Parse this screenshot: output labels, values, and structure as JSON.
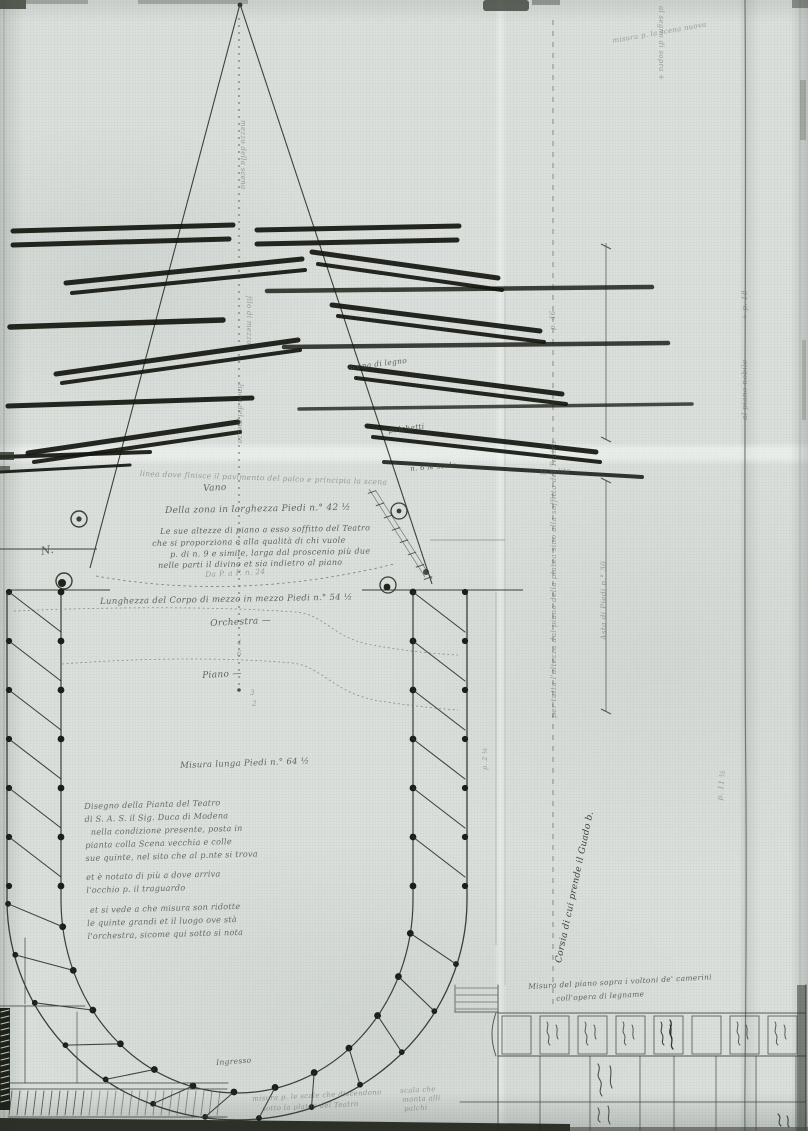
{
  "document_kind": "scanned hand-drawn theatre plan",
  "colors": {
    "paper": "#dbe0dd",
    "ink": "#2e332b",
    "ink_faint": "#6c766c",
    "wing_bars": "#14170f"
  },
  "annotations": {
    "top_right_vertical": "al segno di sopra +",
    "top_right_note": "misura p. la scena nuova",
    "center_line_1": "mezzo della scena",
    "center_line_2": "filo di mezzo",
    "center_line_3": "linea del mezzo",
    "wing_label_1": "scena di legno",
    "wing_label_2": "palchetti",
    "wing_label_3": "n. 6 le scale",
    "wing_label_4": "le solite",
    "stage_front_note": "linea dove finisce il pavimento del palco e principia la scena",
    "vano_label": "Vano",
    "width_note": "Della zona in larghezza Piedi n.° 42 ½",
    "stage_paragraph": [
      "Le sue altezze di piano a esso soffitto del Teatro",
      "che si proporziona e alla qualità di chi vuole",
      "p. di n. 9 e simile, larga dal proscenio più due",
      "nelle parti il divino et sia indietro al piano"
    ],
    "da_p_a_p": "Da P. a P. n. 24",
    "length_note": "Lunghezza del Corpo di mezzo in mezzo Piedi n.° 54 ½",
    "orchestra_label": "Orchestra —",
    "orchestra_fraction": {
      "top": "4",
      "bottom": "6"
    },
    "piano_label": "Piano —",
    "piano_fraction": {
      "top": "3",
      "bottom": "2"
    },
    "measure_note": "Misura lunga Piedi n.° 64 ½",
    "nn_label": "N.",
    "legend_lines": [
      "Disegno della Pianta del Teatro",
      "di S. A. S. il Sig. Duca di Modena",
      "nella condizione presente, posta in",
      "pianta colla Scena vecchia e colle",
      "sue quinte, nel sito che al p.nte si trova",
      "et è notato di più a dove arriva",
      "l'occhio p. il traguardo",
      "et si vede a che misura son ridotte",
      "le quinte grandi et il luogo ove stà",
      "l'orchestra, sicome qui sotto si nota"
    ],
    "ingresso_label": "Ingresso",
    "bottom_note_left": [
      "misura p. le scale che discendono",
      "sotto la platea del Teatro"
    ],
    "bottom_note_right": [
      "scala che",
      "monta alli",
      "palchi"
    ],
    "corridor_rotated": "Corsia di cui prende il Guado b.",
    "side_line_label": "per tutta l'altezza dal piano della platea sino alla soffitta del Teatro",
    "side_line_measure": "p. 46",
    "measuring_rod_label": "Asta di Piedi n.° 30",
    "fold_label_1": "+ p. 18",
    "fold_label_2": "al piano nobile",
    "far_right_label": "p. 11 ½",
    "corridor_width_label": "p. 2 ¼",
    "table_caption": [
      "Misura del piano sopra i voltoni de' camerini",
      "coll'opera di legname"
    ]
  }
}
